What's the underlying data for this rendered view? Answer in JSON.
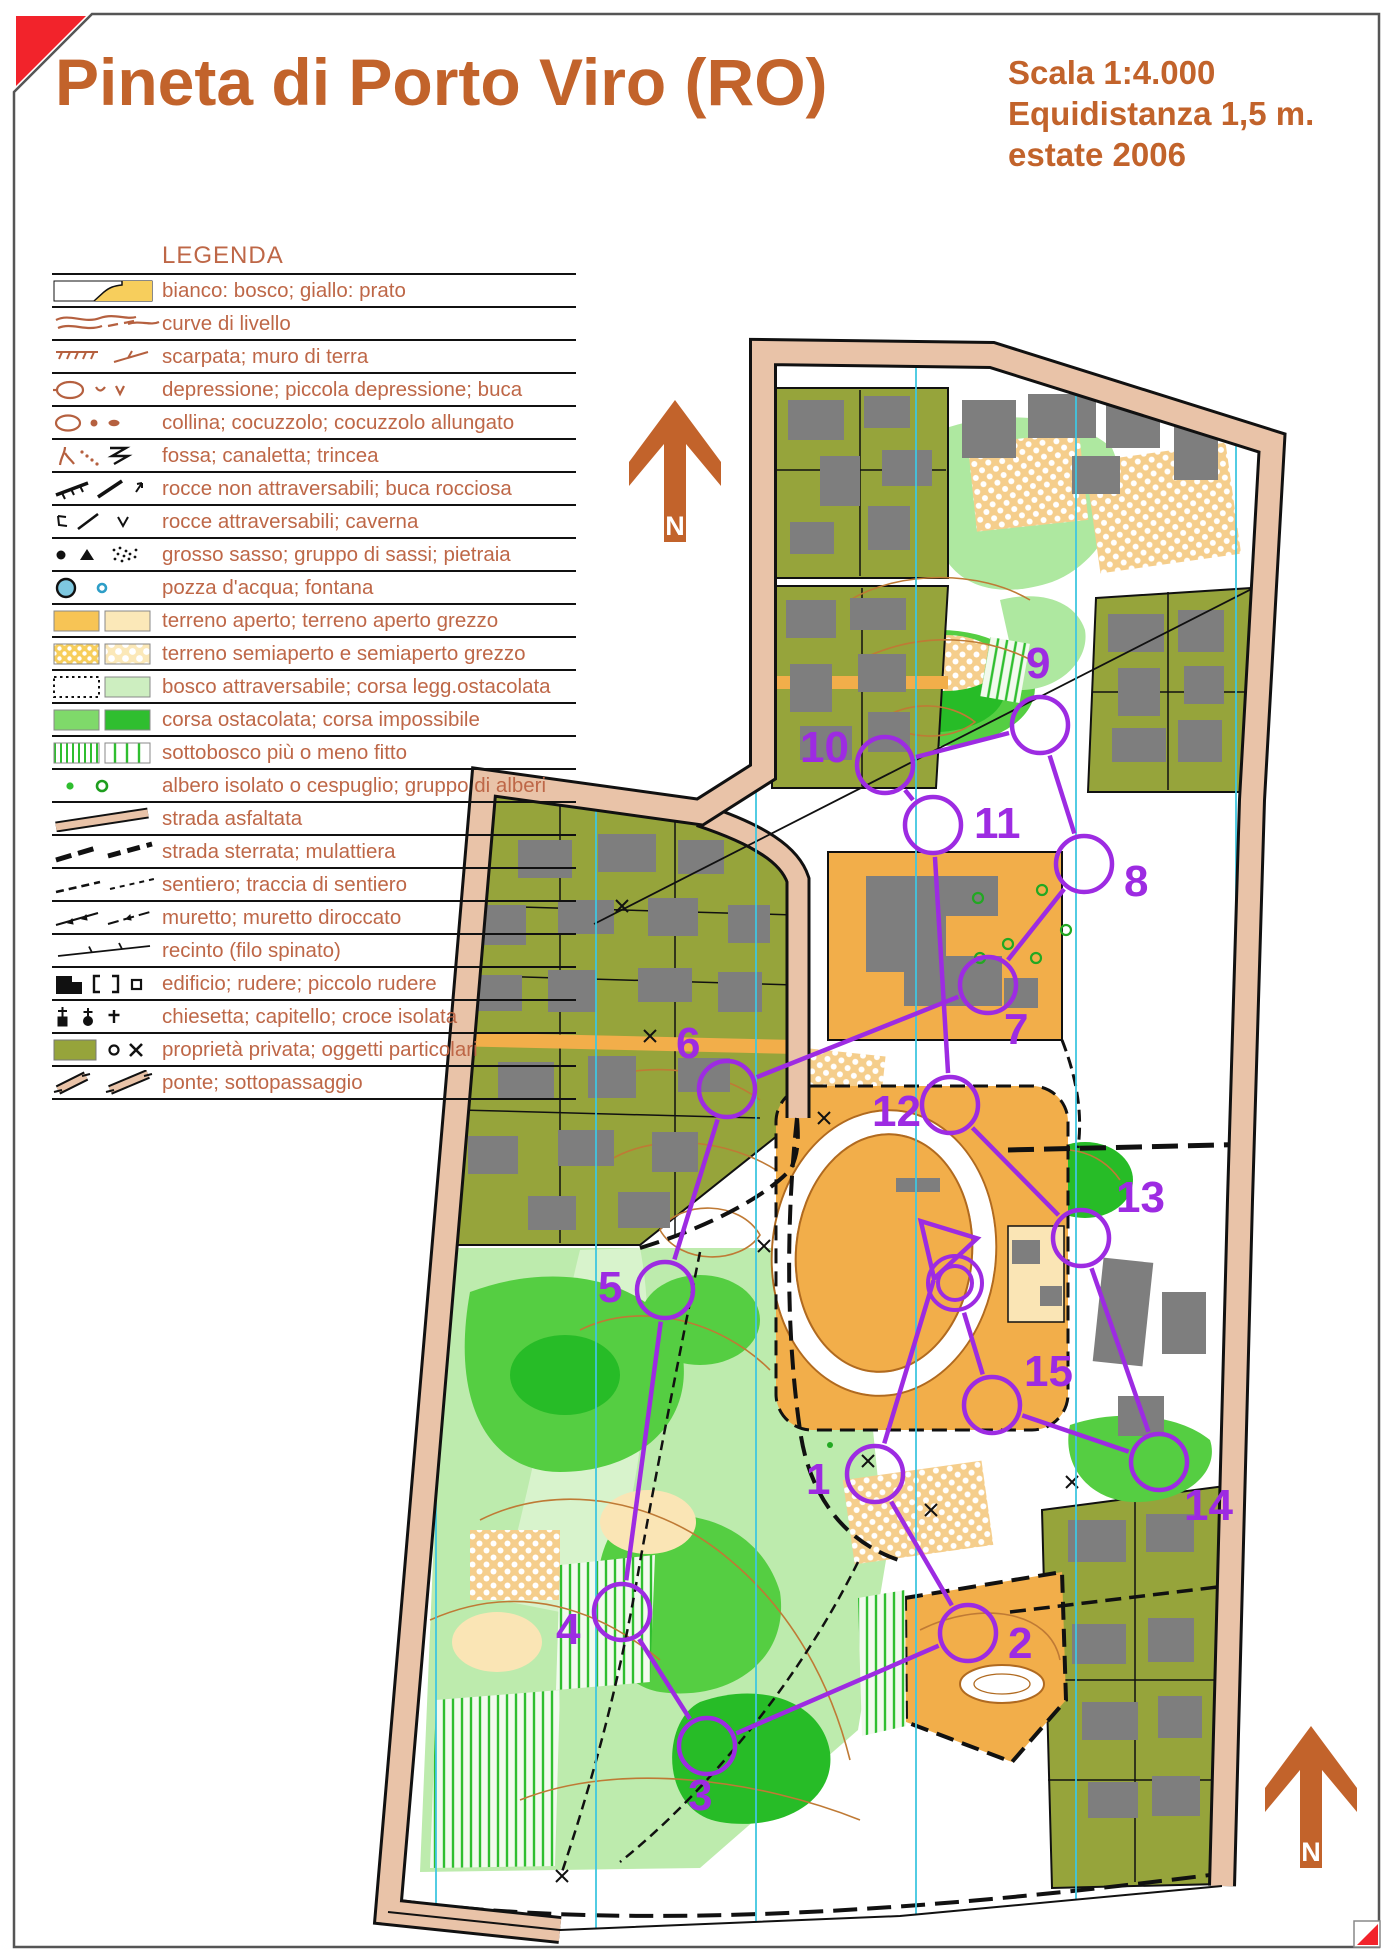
{
  "page": {
    "title": "Pineta di Porto Viro (RO)",
    "info_lines": [
      "Scala 1:4.000",
      "Equidistanza 1,5 m.",
      "estate 2006"
    ],
    "north_label": "N"
  },
  "colors": {
    "accent_orange": "#C2632B",
    "legend_text": "#BE6747",
    "course_purple": "#9D2BE2",
    "map_olive": "#96A43B",
    "map_open_orange": "#F2AE4A",
    "map_rough_open": "#FAE5B5",
    "map_forest_white": "#FFFFFF",
    "map_green_light": "#AEE8A0",
    "map_green_mid": "#55CE42",
    "map_green_dark": "#27BC27",
    "road_band_pink": "#E9C3A8",
    "building_gray": "#7E7E7E",
    "north_line_cyan": "#3FC6E0",
    "contour_brown": "#BF7A35",
    "water_blue": "#7EC8E0",
    "corner_red": "#F2232B"
  },
  "legend": {
    "title": "LEGENDA",
    "items": [
      {
        "symbol": "white-yellow-area-swatch-icon",
        "label": "bianco: bosco; giallo: prato"
      },
      {
        "symbol": "contour-lines-icon",
        "label": "curve di livello"
      },
      {
        "symbol": "earth-bank-wall-icon",
        "label": "scarpata; muro di terra"
      },
      {
        "symbol": "depression-pit-icon",
        "label": "depressione; piccola depressione; buca"
      },
      {
        "symbol": "hill-knoll-icon",
        "label": "collina; cocuzzolo; cocuzzolo allungato"
      },
      {
        "symbol": "gully-ditch-trench-icon",
        "label": "fossa; canaletta; trincea"
      },
      {
        "symbol": "impassable-rocks-icon",
        "label": "rocce non attraversabili; buca rocciosa"
      },
      {
        "symbol": "passable-rocks-cave-icon",
        "label": "rocce attraversabili; caverna"
      },
      {
        "symbol": "boulder-stones-icon",
        "label": "grosso sasso; gruppo di sassi; pietraia"
      },
      {
        "symbol": "waterhole-fountain-icon",
        "label": "pozza d'acqua; fontana"
      },
      {
        "symbol": "open-land-swatch-icon",
        "label": "terreno aperto; terreno aperto grezzo"
      },
      {
        "symbol": "semiopen-land-swatch-icon",
        "label": "terreno semiaperto e semiaperto grezzo"
      },
      {
        "symbol": "passable-forest-swatch-icon",
        "label": "bosco attraversabile; corsa legg.ostacolata"
      },
      {
        "symbol": "slow-run-swatch-icon",
        "label": "corsa ostacolata; corsa impossibile"
      },
      {
        "symbol": "undergrowth-stripes-icon",
        "label": "sottobosco più o meno fitto"
      },
      {
        "symbol": "isolated-tree-icon",
        "label": "albero isolato o cespuglio; gruppo di alberi"
      },
      {
        "symbol": "paved-road-icon",
        "label": "strada asfaltata"
      },
      {
        "symbol": "dirt-road-icon",
        "label": "strada sterrata; mulattiera"
      },
      {
        "symbol": "footpath-icon",
        "label": "sentiero; traccia di sentiero"
      },
      {
        "symbol": "stone-wall-icon",
        "label": "muretto; muretto diroccato"
      },
      {
        "symbol": "wire-fence-icon",
        "label": "recinto (filo spinato)"
      },
      {
        "symbol": "building-ruin-icon",
        "label": "edificio; rudere; piccolo rudere"
      },
      {
        "symbol": "church-cross-icon",
        "label": "chiesetta; capitello; croce isolata"
      },
      {
        "symbol": "private-property-icon",
        "label": "proprietà privata; oggetti particolari"
      },
      {
        "symbol": "bridge-underpass-icon",
        "label": "ponte; sottopassaggio"
      }
    ]
  },
  "course": {
    "color": "#9D2BE2",
    "start": {
      "x": 944,
      "y": 1246,
      "angle_deg": 107
    },
    "finish": {
      "x": 955,
      "y": 1283,
      "r_inner": 17,
      "r_outer": 27
    },
    "controls": [
      {
        "n": 1,
        "x": 875,
        "y": 1474,
        "lx": 806,
        "ly": 1494
      },
      {
        "n": 2,
        "x": 968,
        "y": 1633,
        "lx": 1008,
        "ly": 1658
      },
      {
        "n": 3,
        "x": 707,
        "y": 1746,
        "lx": 688,
        "ly": 1810
      },
      {
        "n": 4,
        "x": 622,
        "y": 1612,
        "lx": 556,
        "ly": 1644
      },
      {
        "n": 5,
        "x": 665,
        "y": 1290,
        "lx": 598,
        "ly": 1302
      },
      {
        "n": 6,
        "x": 727,
        "y": 1089,
        "lx": 676,
        "ly": 1058
      },
      {
        "n": 7,
        "x": 988,
        "y": 985,
        "lx": 1004,
        "ly": 1044
      },
      {
        "n": 8,
        "x": 1084,
        "y": 864,
        "lx": 1124,
        "ly": 896
      },
      {
        "n": 9,
        "x": 1040,
        "y": 725,
        "lx": 1026,
        "ly": 678
      },
      {
        "n": 10,
        "x": 885,
        "y": 765,
        "lx": 800,
        "ly": 762
      },
      {
        "n": 11,
        "x": 933,
        "y": 825,
        "lx": 974,
        "ly": 838
      },
      {
        "n": 12,
        "x": 950,
        "y": 1105,
        "lx": 872,
        "ly": 1126
      },
      {
        "n": 13,
        "x": 1081,
        "y": 1238,
        "lx": 1116,
        "ly": 1212
      },
      {
        "n": 14,
        "x": 1159,
        "y": 1462,
        "lx": 1184,
        "ly": 1520
      },
      {
        "n": 15,
        "x": 992,
        "y": 1405,
        "lx": 1024,
        "ly": 1386
      }
    ],
    "order": [
      "S",
      "1",
      "2",
      "3",
      "4",
      "5",
      "6",
      "7",
      "8",
      "9",
      "10",
      "11",
      "12",
      "13",
      "14",
      "15",
      "F"
    ]
  }
}
